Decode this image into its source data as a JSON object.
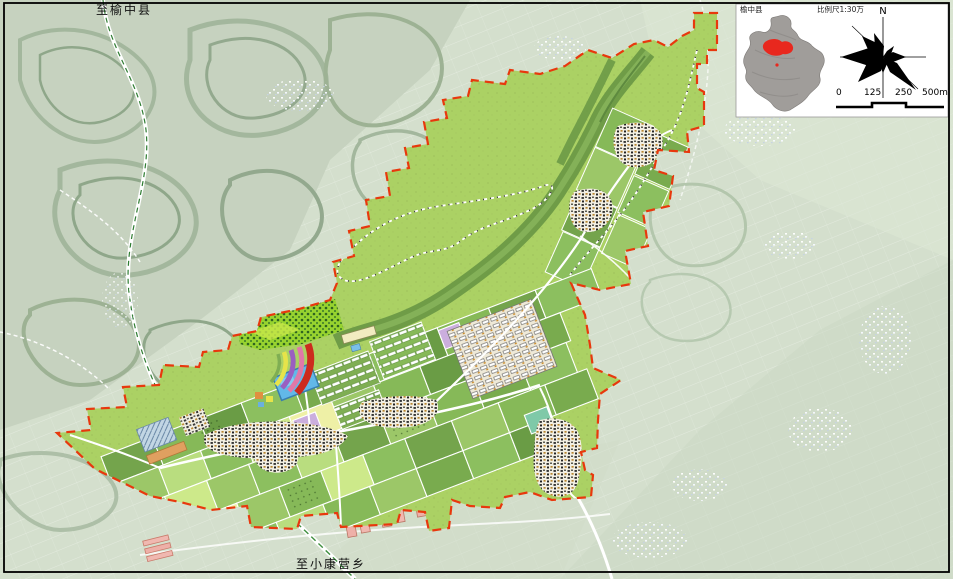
{
  "labels": {
    "road_to_north": "至榆中县",
    "road_to_south": "至小康营乡"
  },
  "inset": {
    "label_left": "榆中县",
    "label_right": "比例尺1:30万",
    "compass_north_label": "N",
    "scale_bar": {
      "ticks": [
        "0",
        "125",
        "250",
        "500m"
      ]
    }
  },
  "legend_colors": {
    "planning_area_fill": "#abd164",
    "boundary_dash_red": "#e8380d",
    "valley_green": "#6c9946",
    "water_blue": "#62b8e8",
    "village_speckle": "#f2efe3",
    "forest_bright": "#97d32f",
    "background_aerial": "#d4dfcd",
    "locator_red": "#e8281e"
  }
}
